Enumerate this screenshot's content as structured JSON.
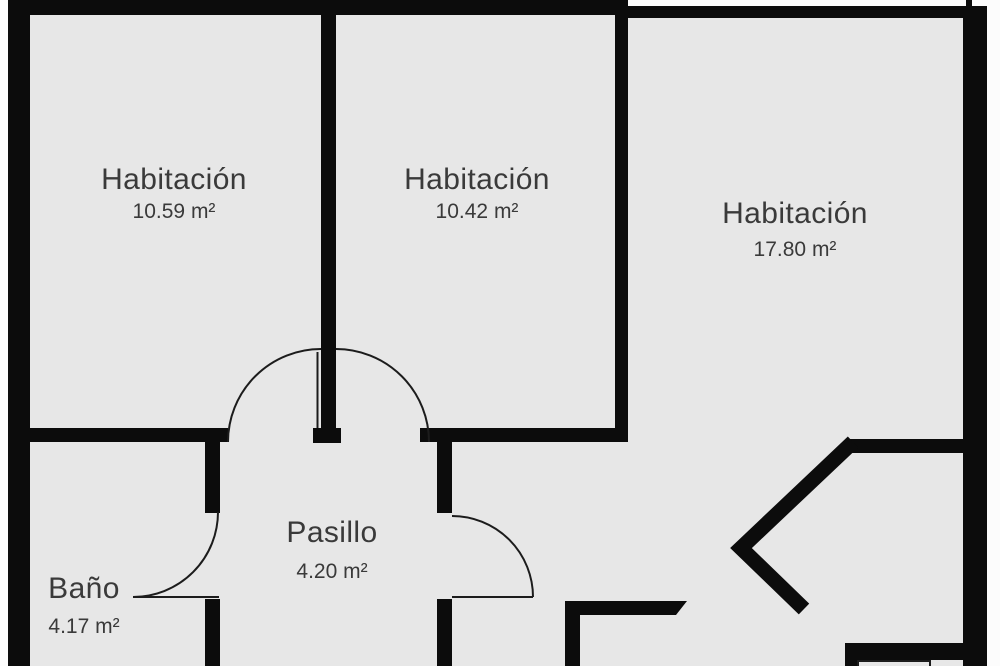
{
  "colors": {
    "wall": "#0c0c0c",
    "floor": "#e7e7e7",
    "background": "#fcfcfc",
    "door_line": "#1c1c1c",
    "label": "#3a3a3a"
  },
  "rooms": [
    {
      "id": "habitacion-1",
      "name": "Habitación",
      "area": "10.59 m²"
    },
    {
      "id": "habitacion-2",
      "name": "Habitación",
      "area": "10.42 m²"
    },
    {
      "id": "habitacion-3",
      "name": "Habitación",
      "area": "17.80 m²"
    },
    {
      "id": "pasillo",
      "name": "Pasillo",
      "area": "4.20 m²"
    },
    {
      "id": "bano",
      "name": "Baño",
      "area": "4.17 m²"
    }
  ]
}
